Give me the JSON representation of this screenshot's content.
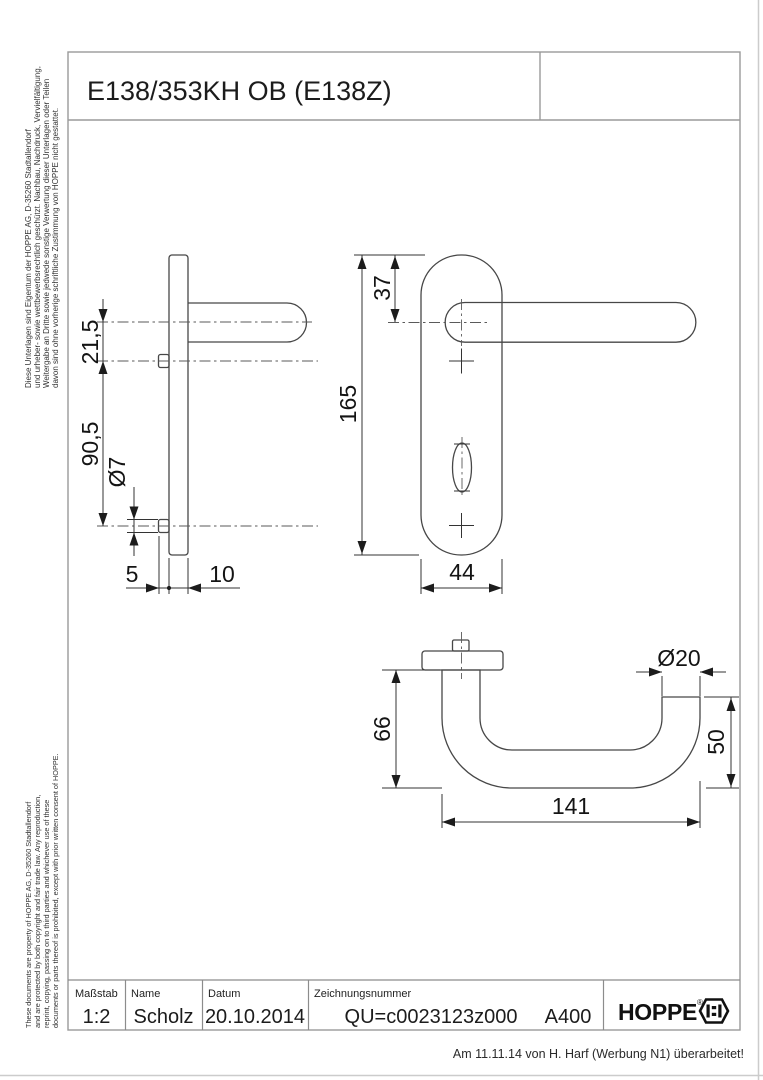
{
  "page": {
    "title": "E138/353KH OB (E138Z)",
    "note": "Am 11.11.14 von H. Harf (Werbung N1) überarbeitet!"
  },
  "legal": {
    "german": {
      "line1": "Diese Unterlagen sind Eigentum der  HOPPE AG, D-35260 Stadtallendorf",
      "line2": "und urheber- sowie wettbewerbsrechtlich geschützt. Nachbau, Nachdruck, Vervielfältigung,",
      "line3": "Weitergabe an Dritte sowie jedwede sonstige Verwertung dieser Unterlagen oder Teilen",
      "line4": "davon sind ohne vorherige schriftliche Zustimmung von HOPPE nicht gestattet."
    },
    "english": {
      "line1": "These documents are property of  HOPPE AG, D-35260 Stadtallendorf",
      "line2": "and are protected by both copyright and fair trade law. Any reproduction,",
      "line3": "reprint, copying, passing on to third parties and whichever use of these",
      "line4": "documents or parts thereof is prohibited, except with prior written consent of  HOPPE."
    }
  },
  "dimensions": {
    "side_view": {
      "handle_offset": "21,5",
      "hole_spacing": "90,5",
      "hole_diameter": "Ø7",
      "boss_height": "5",
      "plate_thickness": "10"
    },
    "front_view": {
      "handle_offset": "37",
      "plate_height": "165",
      "plate_width": "44"
    },
    "top_view": {
      "handle_depth": "66",
      "handle_length": "141",
      "grip_diameter": "Ø20",
      "grip_end_depth": "50"
    }
  },
  "title_block": {
    "scale_label": "Maßstab",
    "scale_value": "1:2",
    "name_label": "Name",
    "name_value": "Scholz",
    "date_label": "Datum",
    "date_value": "20.10.2014",
    "drawing_number_label": "Zeichnungsnummer",
    "drawing_number_value": "QU=c0023123z000",
    "revision": "A400",
    "brand": "HOPPE",
    "registered_mark": "®"
  },
  "colors": {
    "drawing_line": "#474747",
    "dimension_text": "#141414",
    "frame_line": "#9a9a9a",
    "scan_edge": "#cccccc",
    "background": "#ffffff"
  }
}
